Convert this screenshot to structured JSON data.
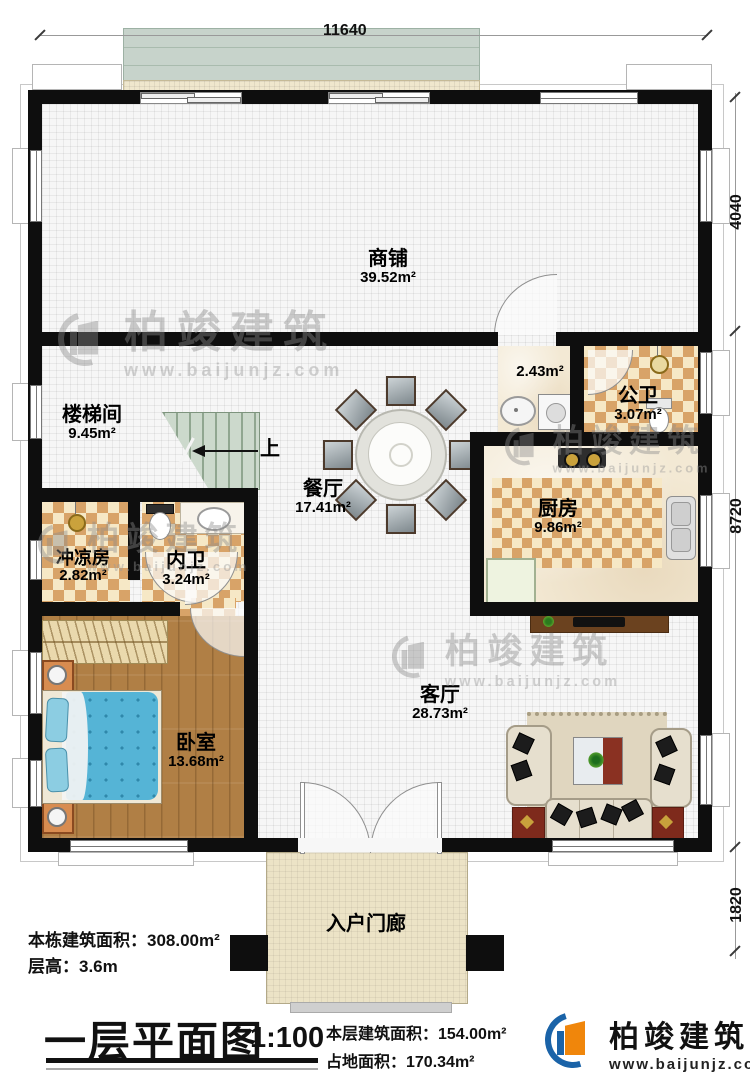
{
  "dimensions": {
    "top": "11640",
    "right_upper": "4040",
    "right_middle": "8720",
    "right_lower": "1820"
  },
  "stairs": {
    "up": "上"
  },
  "rooms": {
    "shop": {
      "name": "商铺",
      "area": "39.52m²"
    },
    "stairwell": {
      "name": "楼梯间",
      "area": "9.45m²"
    },
    "corridor": {
      "area": "2.43m²"
    },
    "public_bath": {
      "name": "公卫",
      "area": "3.07m²"
    },
    "dining": {
      "name": "餐厅",
      "area": "17.41m²"
    },
    "kitchen": {
      "name": "厨房",
      "area": "9.86m²"
    },
    "shower_room": {
      "name": "冲凉房",
      "area": "2.82m²"
    },
    "ensuite_bath": {
      "name": "内卫",
      "area": "3.24m²"
    },
    "bedroom": {
      "name": "卧室",
      "area": "13.68m²"
    },
    "living": {
      "name": "客厅",
      "area": "28.73m²"
    },
    "porch": {
      "name": "入户门廊"
    }
  },
  "info": {
    "building_total": "本栋建筑面积：308.00m²",
    "floor_height": "层高：3.6m"
  },
  "title_block": {
    "title": "一层平面图",
    "scale": "1:100",
    "floor_area": "本层建筑面积：154.00m²",
    "footprint": "占地面积：170.34m²"
  },
  "brand": {
    "name": "柏竣建筑",
    "website": "www.baijunjz.com"
  },
  "watermark": {
    "name": "柏竣建筑",
    "website": "www.baijunjz.com"
  },
  "colors": {
    "wall": "#0e0e0e",
    "checker": "#d8a368",
    "wood": "#b07f45",
    "bed": "#55b4d6",
    "brand_blue": "#1a63a8",
    "brand_orange": "#f0860b"
  }
}
